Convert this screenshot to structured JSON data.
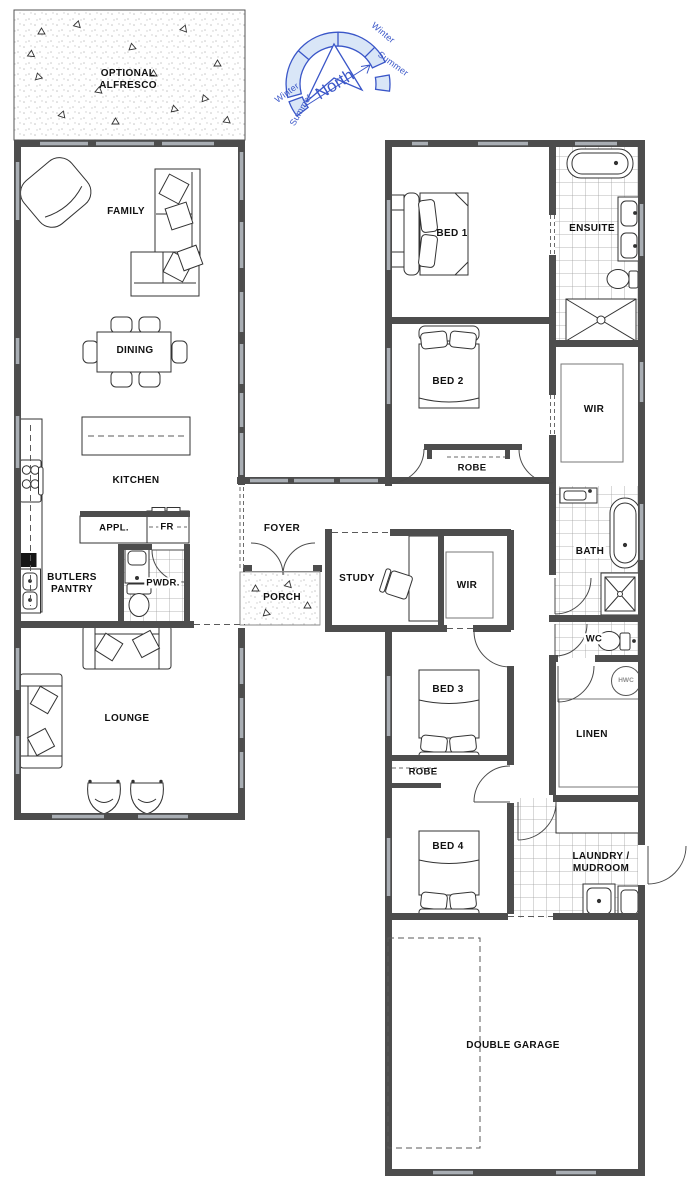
{
  "title": "House floor plan",
  "compass": {
    "north": "North",
    "winter_left": "Winter",
    "summer_left": "Summer",
    "winter_right": "Winter",
    "summer_right": "Summer"
  },
  "rooms": {
    "alfresco": "OPTIONAL ALFRESCO",
    "family": "FAMILY",
    "dining": "DINING",
    "kitchen": "KITCHEN",
    "appliances": "APPL.",
    "fridge": "FR",
    "butlers_pantry": "BUTLERS PANTRY",
    "powder": "PWDR.",
    "lounge": "LOUNGE",
    "foyer": "FOYER",
    "porch": "PORCH",
    "study": "STUDY",
    "wir_middle": "WIR",
    "wir_main": "WIR",
    "bed1": "BED 1",
    "ensuite": "ENSUITE",
    "bed2": "BED 2",
    "robe_bed2": "ROBE",
    "bath": "BATH",
    "wc": "WC",
    "hwc": "HWC",
    "bed3": "BED 3",
    "linen": "LINEN",
    "robe_bed3": "ROBE",
    "bed4": "BED 4",
    "laundry": "LAUNDRY / MUDROOM",
    "garage": "DOUBLE GARAGE"
  },
  "colors": {
    "wall": "#4d4d4d",
    "window": "#a9aeb4",
    "label": "#111111",
    "compass_stroke": "#3a56c8",
    "compass_fill": "#d9e6f7",
    "tile_line": "#a0a0a0",
    "stipple": "#c2c2c2"
  }
}
